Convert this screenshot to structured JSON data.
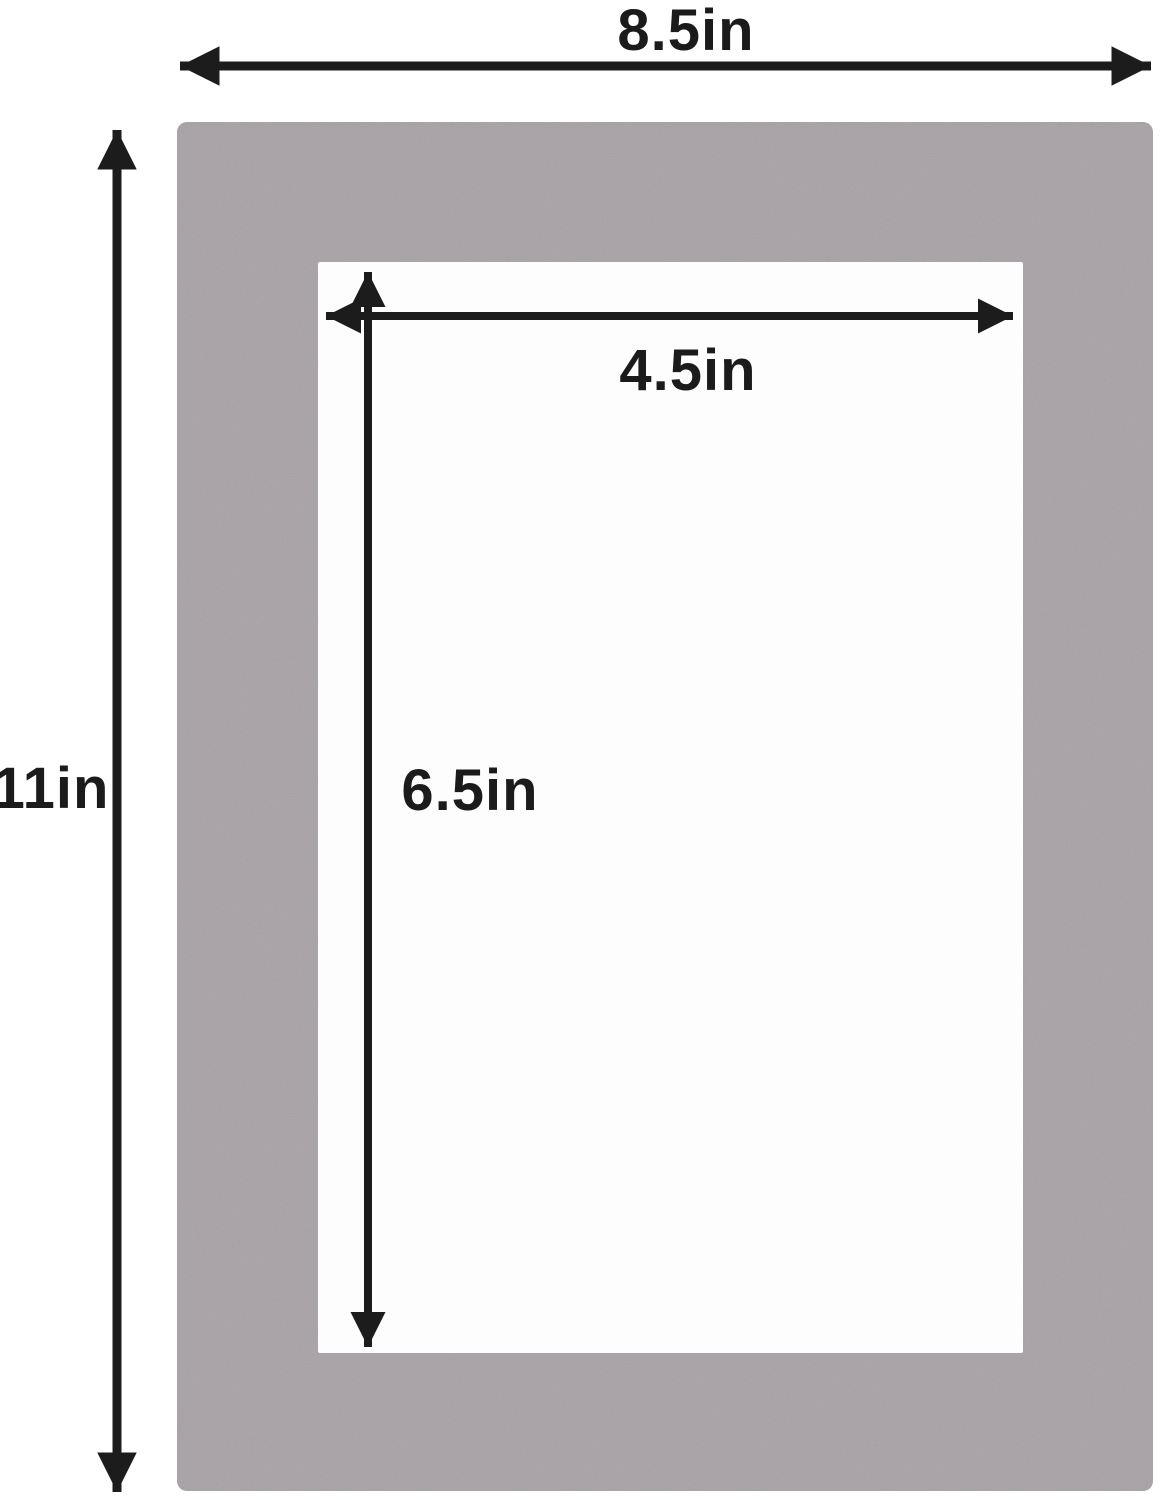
{
  "diagram": {
    "description": "Picture frame mat board dimension diagram",
    "labels": {
      "outer_width": "8.5in",
      "outer_height": "11in",
      "opening_width": "4.5in",
      "opening_height": "6.5in"
    },
    "colors": {
      "mat_board": "#a8a2a6",
      "opening": "#fdfdfd",
      "arrow": "#1c1c1c",
      "background": "#ffffff"
    }
  }
}
